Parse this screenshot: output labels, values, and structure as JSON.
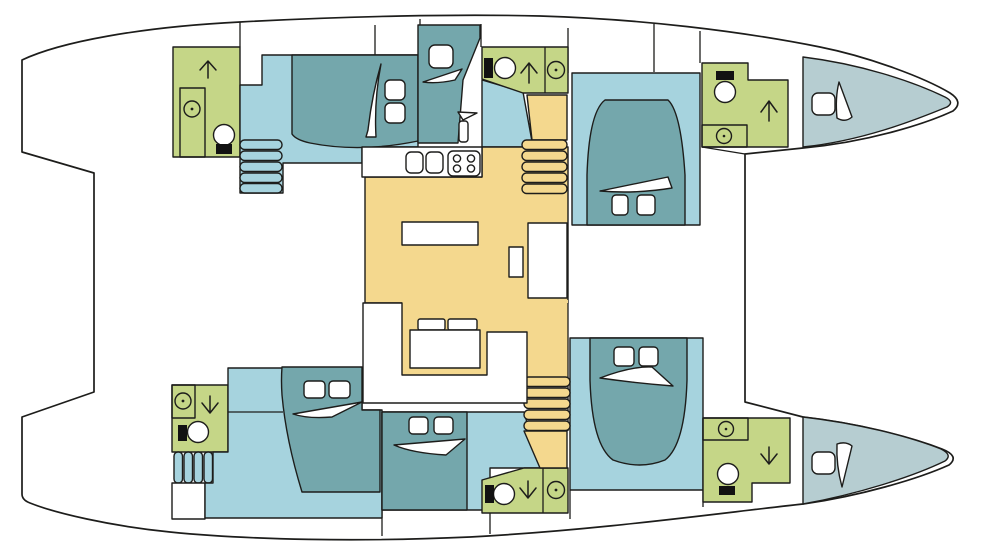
{
  "diagram": {
    "type": "boat-floor-plan",
    "subject": "catamaran layout, top-down view, bows to the right",
    "decks": [
      "port-hull",
      "bridgedeck-salon",
      "starboard-hull"
    ]
  },
  "colors": {
    "background": "#ffffff",
    "outline": "#1d1d1b",
    "cabin_floor": "#a6d3de",
    "bed": "#74a7ac",
    "bathroom": "#c5d687",
    "salon": "#f4d88e",
    "bow_berth": "#b6cdd1",
    "fixture_white": "#ffffff",
    "toilet_seat_black": "#121212"
  },
  "icons": {
    "shower": "circle-with-center-dot",
    "toilet": "bowl-circle-with-black-tank",
    "companionway_up": "up-arrow",
    "companionway_down": "down-arrow",
    "stairs": "rounded-step-bars",
    "bed_blanket": "white-sail-swoosh",
    "pillow": "rounded-white-square"
  },
  "inventory": {
    "double_cabins": 4,
    "bow_berths": 2,
    "single_berth": 1,
    "bathrooms": 4,
    "shower_stalls": 6,
    "toilets": 6,
    "companionway_arrows_up": 3,
    "companionway_arrows_down": 3,
    "galley": {
      "sink_basins": 2,
      "stove_burners": 4
    },
    "salon": {
      "tables": 2,
      "nav_desk": 1,
      "sofa": "U-shaped",
      "cushions": 2
    }
  }
}
